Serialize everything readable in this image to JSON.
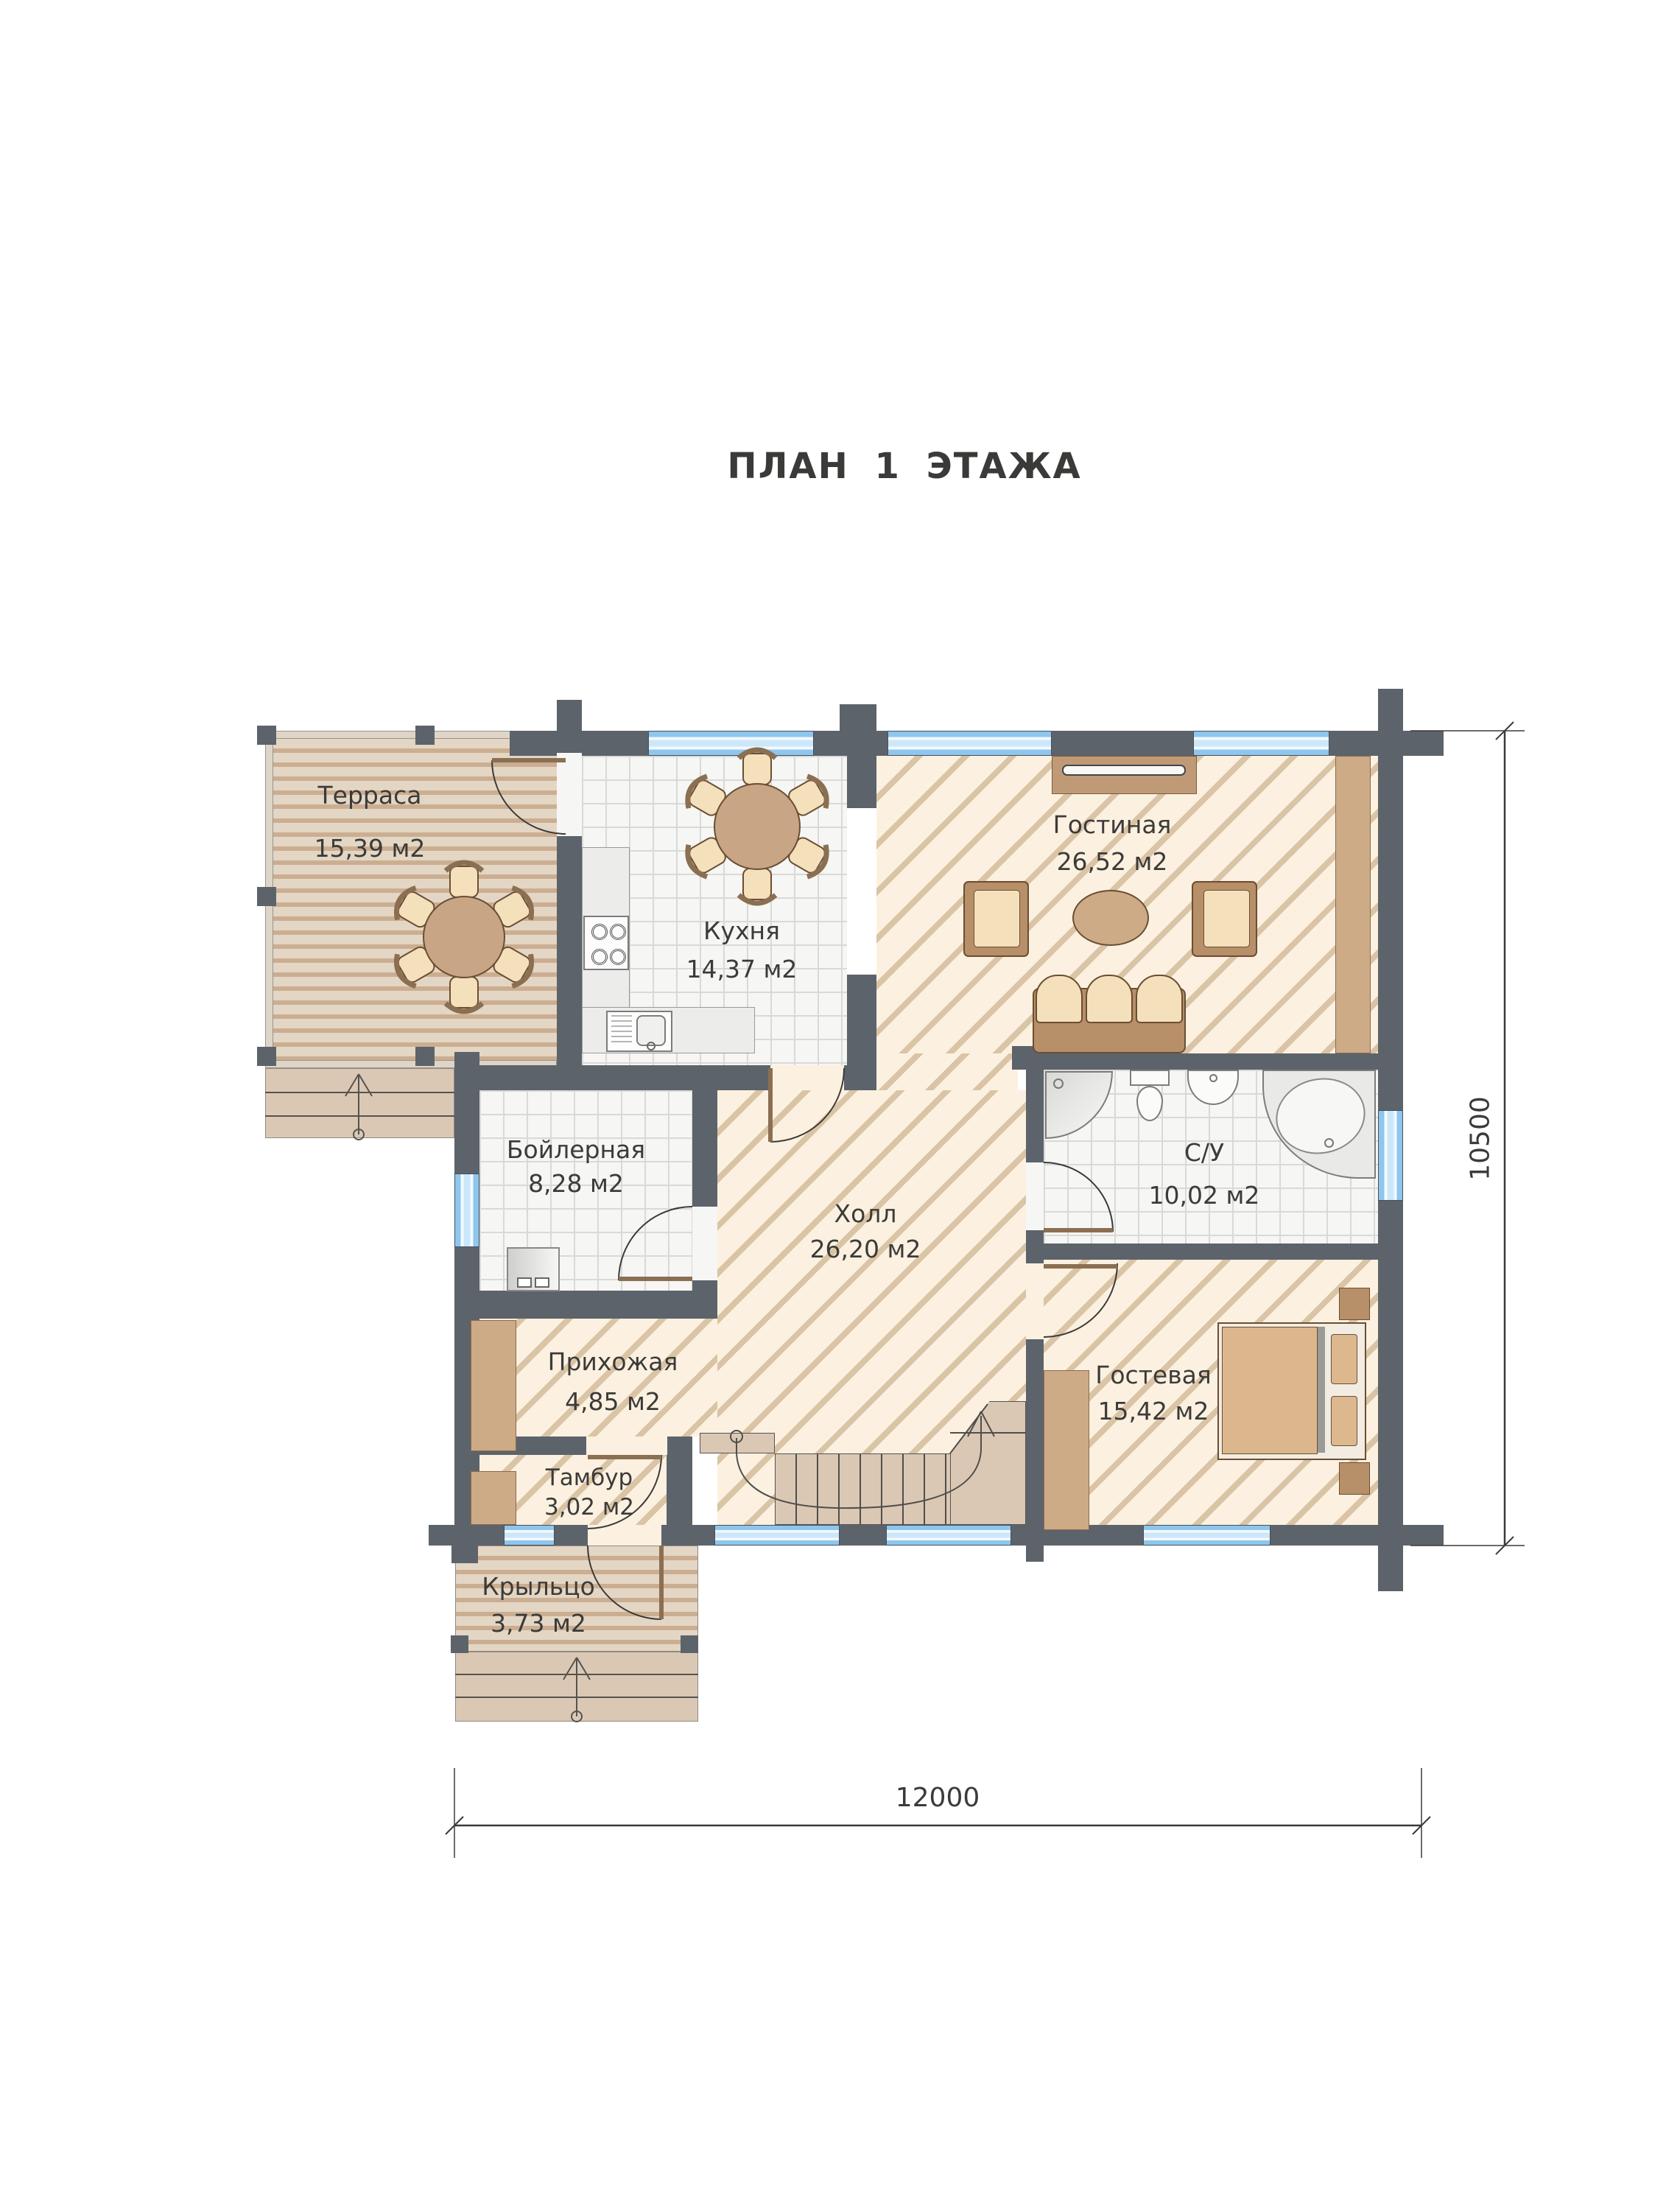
{
  "title": "ПЛАН 1 ЭТАЖА",
  "rooms": [
    {
      "id": "terrace",
      "name": "Терраса",
      "area": "15,39 м2"
    },
    {
      "id": "kitchen",
      "name": "Кухня",
      "area": "14,37 м2"
    },
    {
      "id": "living",
      "name": "Гостиная",
      "area": "26,52 м2"
    },
    {
      "id": "boiler",
      "name": "Бойлерная",
      "area": "8,28 м2"
    },
    {
      "id": "hall",
      "name": "Холл",
      "area": "26,20 м2"
    },
    {
      "id": "bathroom",
      "name": "С/У",
      "area": "10,02 м2"
    },
    {
      "id": "entry",
      "name": "Прихожая",
      "area": "4,85 м2"
    },
    {
      "id": "guest",
      "name": "Гостевая",
      "area": "15,42 м2"
    },
    {
      "id": "vestibule",
      "name": "Тамбур",
      "area": "3,02 м2"
    },
    {
      "id": "porch",
      "name": "Крыльцо",
      "area": "3,73 м2"
    }
  ],
  "dimensions": {
    "bottom_width": "12000",
    "right_height": "10500"
  },
  "colors": {
    "wall": "#5d636a",
    "window_blue": "#8ec6ee",
    "hatch_bg": "#fcf1e0",
    "hatch_line": "#dac4a6",
    "wood_light": "#e4d6c4",
    "wood_dark": "#cbae91",
    "stair_tan": "#dac8b5",
    "furniture_brown": "#b78f68",
    "cushion": "#f4e0bb",
    "text": "#3b3b39"
  }
}
